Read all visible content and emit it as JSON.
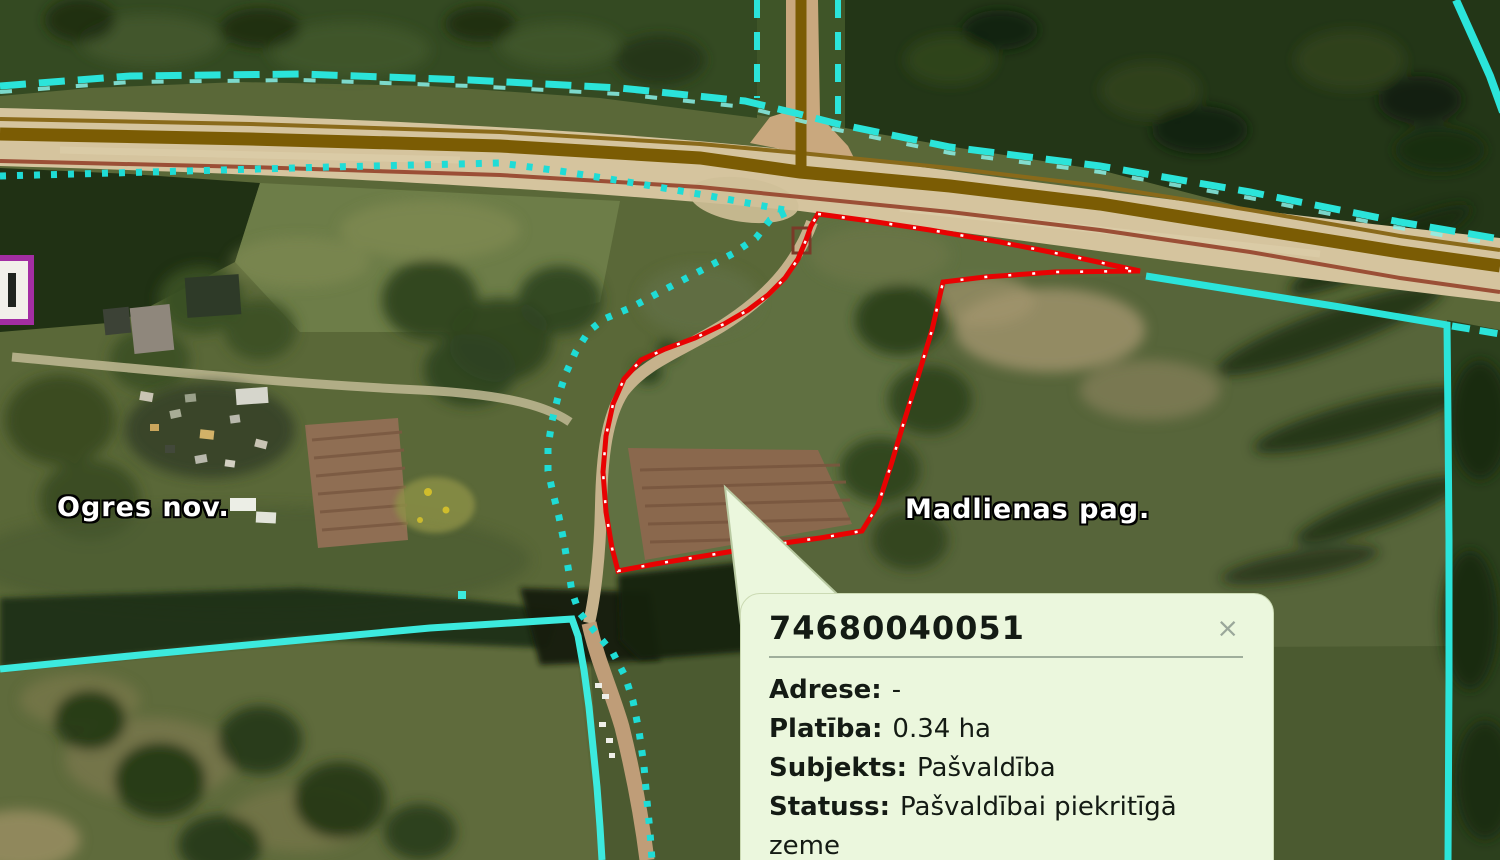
{
  "map": {
    "region_labels": [
      {
        "text": "Ogres nov."
      },
      {
        "text": "Madlienas pag."
      }
    ],
    "colors": {
      "boundary_cyan": "#2be4da",
      "boundary_cyan_light": "#8af2ea",
      "parcel_red": "#e80202",
      "road_center_brown": "#7b5c04",
      "road_edge_maroon": "#9b4f36",
      "popup_background": "#ebf7dd",
      "edge_marker_purple": "#a32ea3"
    }
  },
  "popup": {
    "title": "74680040051",
    "close_label": "×",
    "fields": [
      {
        "label": "Adrese:",
        "value": "-"
      },
      {
        "label": "Platība:",
        "value": "0.34 ha"
      },
      {
        "label": "Subjekts:",
        "value": "Pašvaldība"
      },
      {
        "label": "Statuss:",
        "value": "Pašvaldībai piekritīgā zeme"
      }
    ]
  }
}
